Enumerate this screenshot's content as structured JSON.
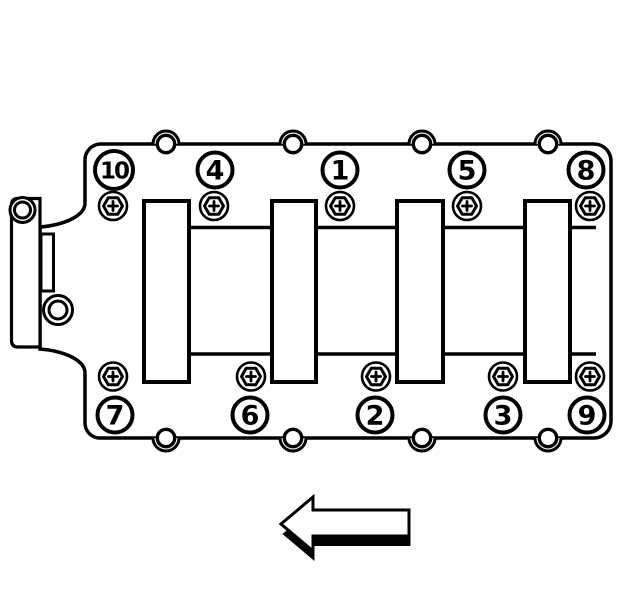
{
  "callouts": {
    "top": [
      {
        "number": "10"
      },
      {
        "number": "4"
      },
      {
        "number": "1"
      },
      {
        "number": "5"
      },
      {
        "number": "8"
      }
    ],
    "bottom": [
      {
        "number": "7"
      },
      {
        "number": "6"
      },
      {
        "number": "2"
      },
      {
        "number": "3"
      },
      {
        "number": "9"
      }
    ]
  },
  "arrow": {
    "direction": "left"
  },
  "colors": {
    "line": "#000000",
    "background": "#ffffff",
    "fill": "#ffffff"
  }
}
